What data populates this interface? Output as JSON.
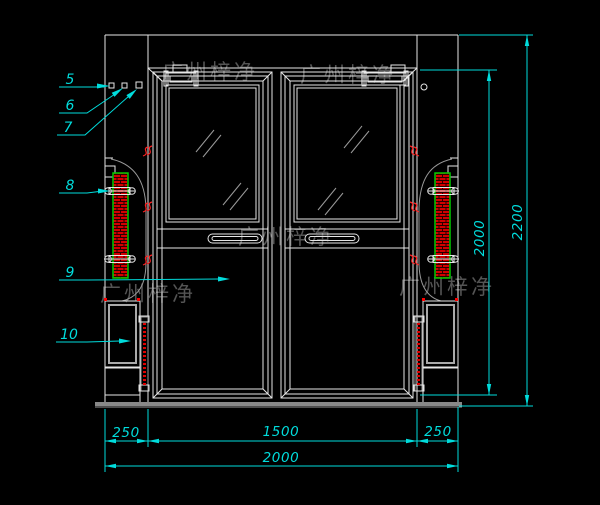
{
  "drawing_title": "double-swing-door-elevation",
  "watermark": {
    "text": "广州梓净"
  },
  "callouts": {
    "c5": "5",
    "c6": "6",
    "c7": "7",
    "c8": "8",
    "c9": "9",
    "c10": "10"
  },
  "dimensions": {
    "bottom_left": "250",
    "bottom_center": "1500",
    "bottom_right": "250",
    "bottom_total": "2000",
    "right_door_height": "2000",
    "right_total_height": "2200"
  },
  "colors": {
    "background": "#000000",
    "linework": "#e6e6e6",
    "dimension_cyan": "#00dcdc",
    "hatch_red": "#d40000",
    "hatch_border_green": "#00cc00",
    "mark_red": "#ff2020",
    "watermark_gray": "#5c5c5c"
  }
}
